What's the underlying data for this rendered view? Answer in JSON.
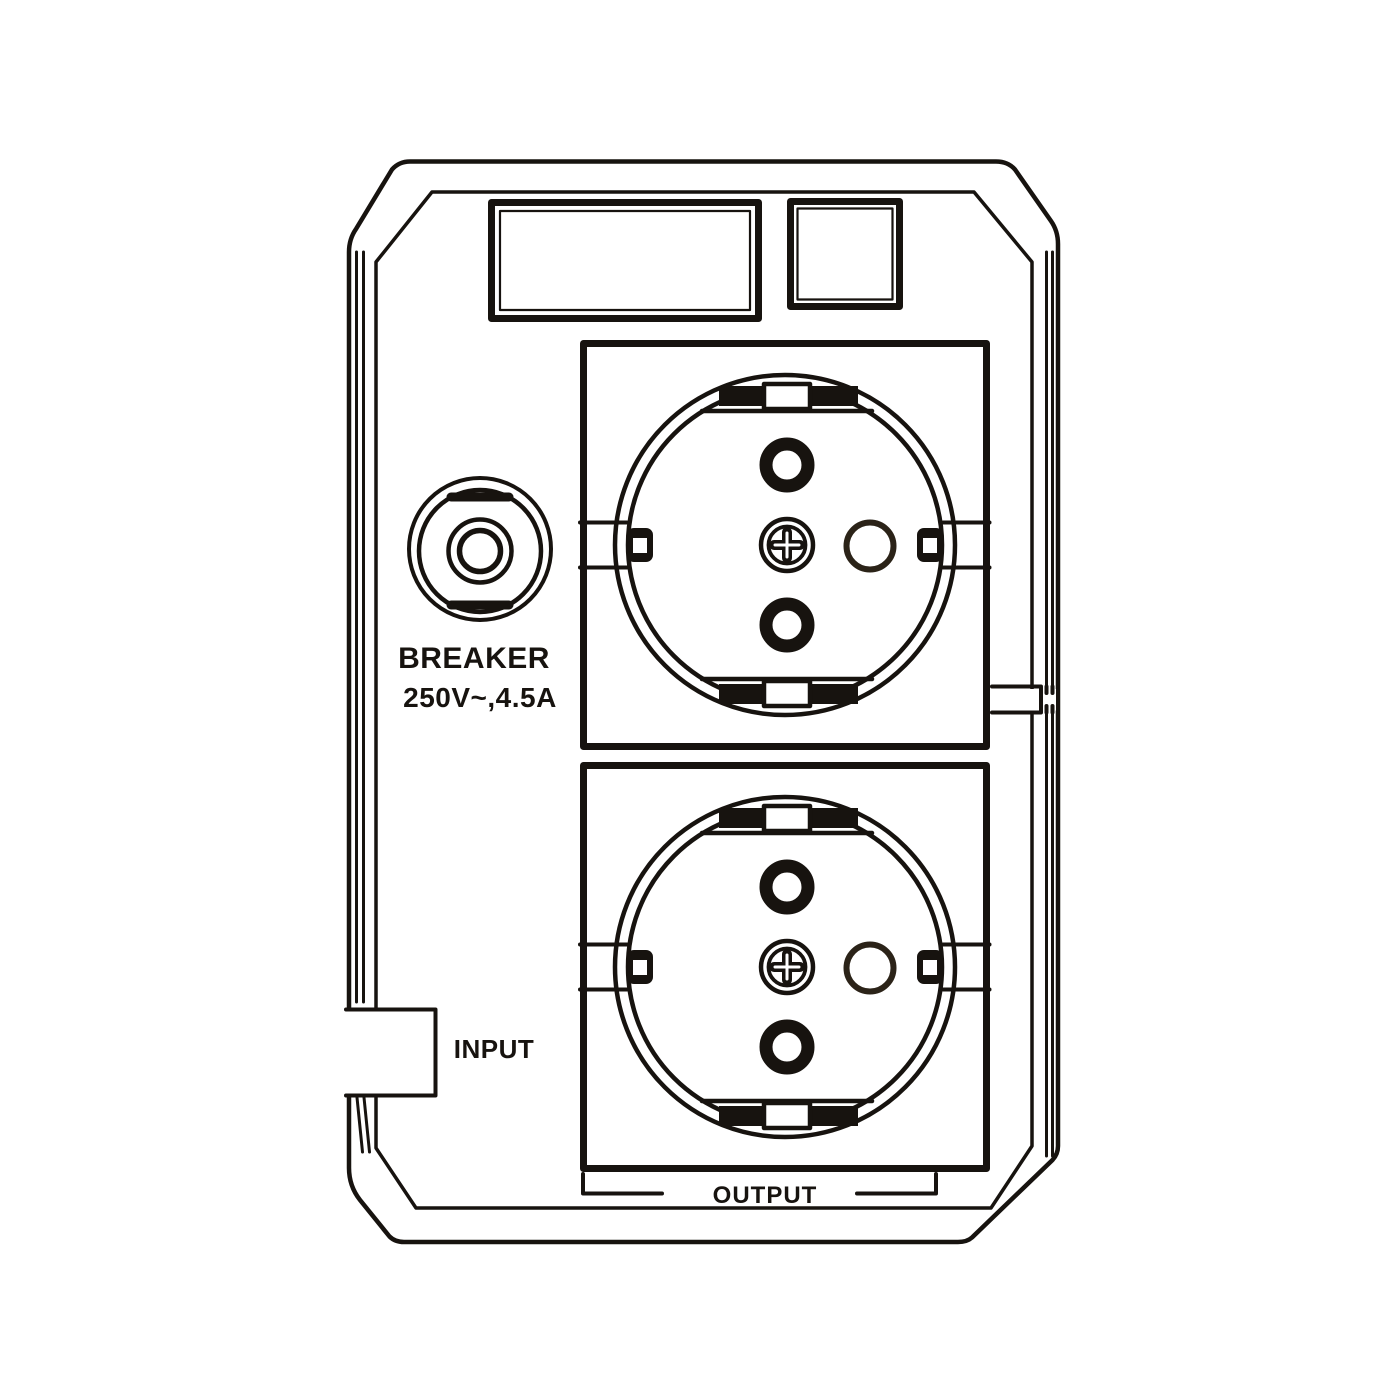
{
  "labels": {
    "breaker_title": "BREAKER",
    "breaker_rating": "250V~,4.5A",
    "input": "INPUT",
    "output": "OUTPUT"
  },
  "colors": {
    "line": "#17130f",
    "secondary_line": "#2b2318",
    "background": "#ffffff"
  },
  "components": {
    "display_window": "display-window",
    "indicator_window": "indicator-window",
    "breaker_button": "breaker-button-icon",
    "socket_top": "schuko-socket-icon",
    "socket_bottom": "schuko-socket-icon",
    "input_notch": "input-cable-notch",
    "output_bracket": "output-sockets-bracket"
  }
}
